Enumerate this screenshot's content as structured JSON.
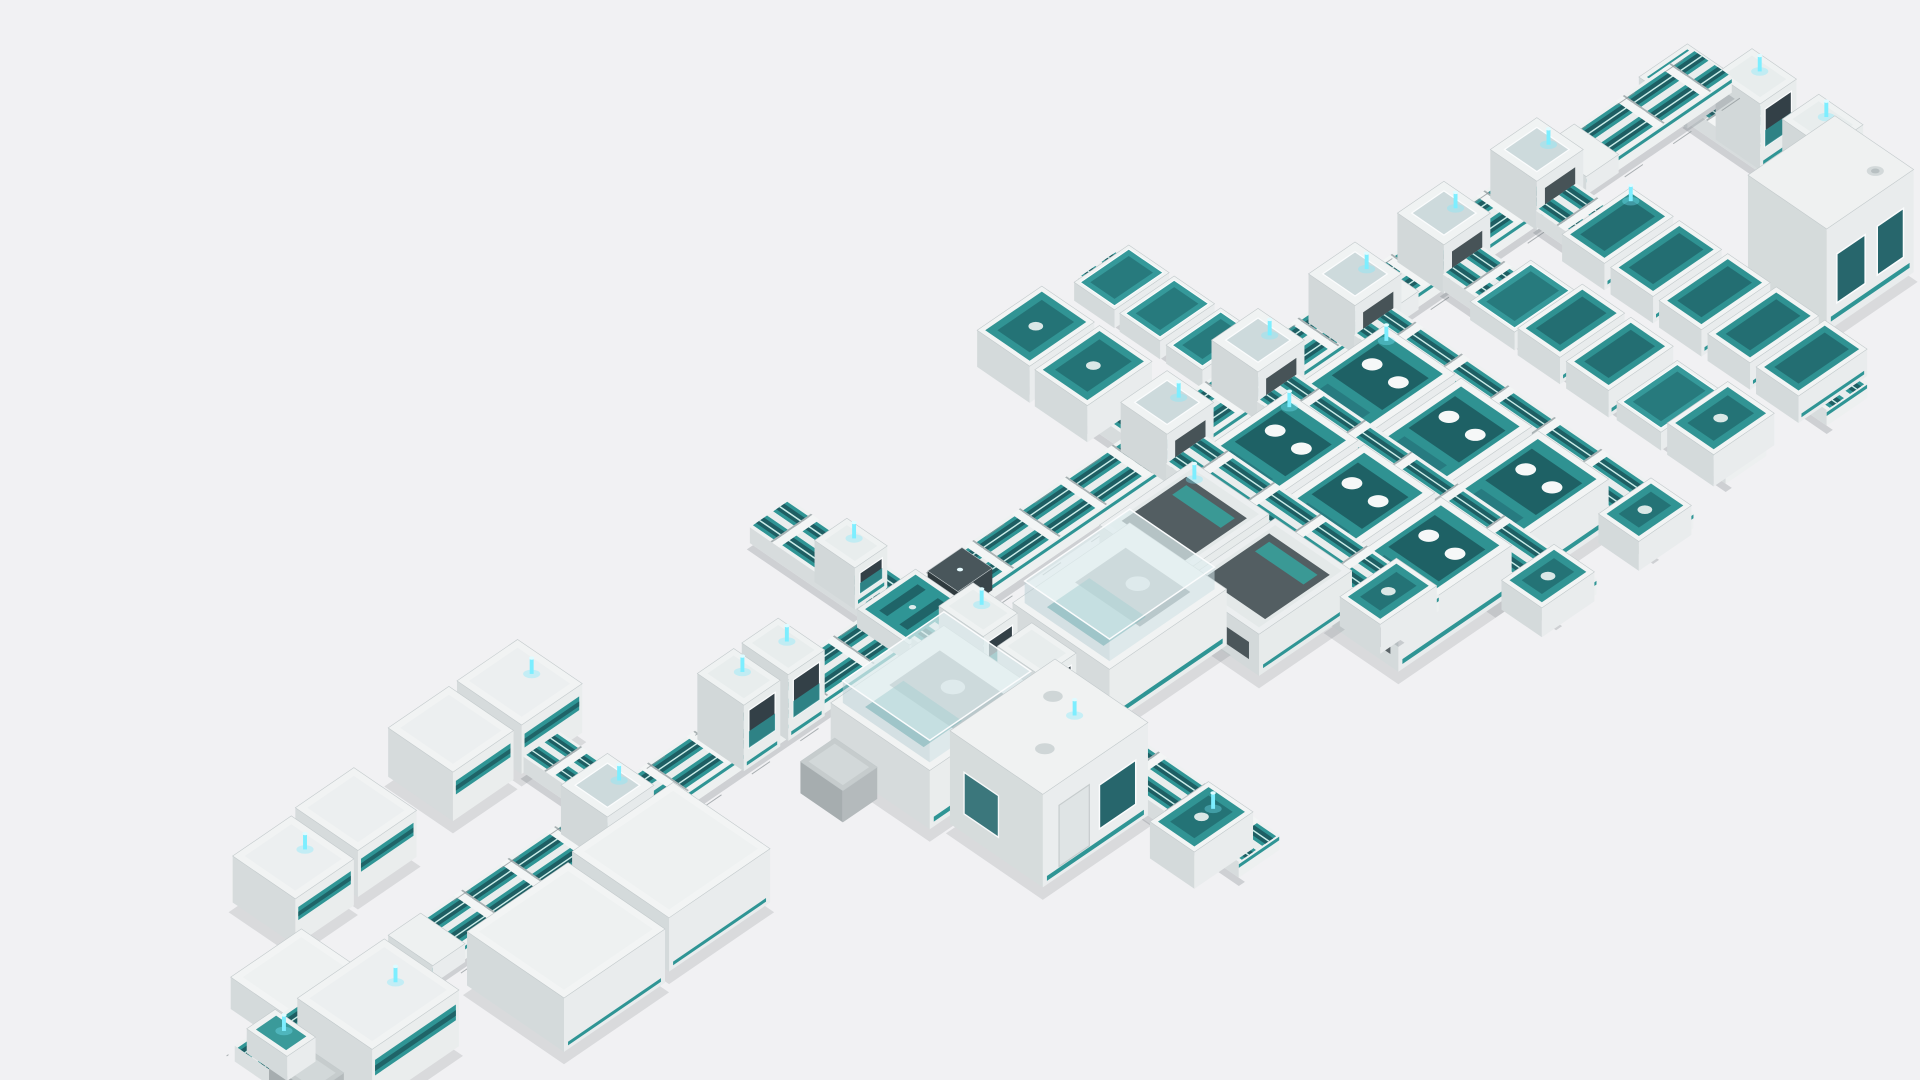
{
  "scene": {
    "name": "lab-automation-line-3d-render",
    "background": "#f1f1f3",
    "palette": {
      "bg": "#f1f1f3",
      "teal": "#2f9595",
      "tealDeck": "#2f9292",
      "tealDark": "#1e5e63",
      "tealDeep": "#1d5d62",
      "tealPale": "#c9ece8",
      "tealMid": "#26777c",
      "windowTeal": "#27666c",
      "white": "#f3f5f5",
      "topFace": "#f2f4f4",
      "seFace": "#e9eced",
      "swFace": "#d4dadb",
      "trackSide": "#edf0f0",
      "trackBase": "#eef1f1",
      "centerStrip": "#e9eded",
      "rib": "#f3f5f5",
      "ribEdge": "#a9b1b3",
      "slate": "#39454a",
      "slateLight": "#49565b",
      "slateDark": "#2f3a3e",
      "gray1": "#c6cccd",
      "gray2": "#b4babc",
      "gray3": "#a6adaf",
      "glassTop": "rgba(224,238,240,0.7)",
      "glassSE": "rgba(205,224,228,0.55)",
      "glassSW": "rgba(184,205,211,0.5)",
      "glassCube": "rgba(176,196,201,0.55)",
      "frame": "#fbfcfd",
      "beacon": "#7deeff",
      "beaconTip": "#dffbff",
      "beaconGlow": "rgba(120,235,255,0.35)",
      "shadow": "rgba(70,80,88,0.14)",
      "trackShadow": "rgba(80,92,98,0.22)",
      "guide": "#8b9396",
      "edgeStroke": "#c3cacc"
    },
    "projection": {
      "ox": 1378,
      "oy": 78,
      "ax": 0.825,
      "ay": 0.565,
      "w": 1568,
      "h": 883
    },
    "elements": [
      {
        "t": "vtrack",
        "name": "return-branch-track",
        "u": -20,
        "w": 40,
        "v0": 18,
        "v1": 164
      },
      {
        "t": "plate",
        "name": "corner-junction",
        "u": -24,
        "wu": 48,
        "v": -24,
        "wv": 48,
        "h": 15,
        "deck": true
      },
      {
        "t": "gate",
        "name": "gate-module",
        "u": -18,
        "wu": 36,
        "v": 46,
        "wv": 44,
        "h": 54,
        "beacon": true
      },
      {
        "t": "gate",
        "name": "gate-module",
        "u": -18,
        "wu": 36,
        "v": 112,
        "wv": 44,
        "h": 54,
        "beacon": true
      },
      {
        "t": "cabinet",
        "name": "analyzer-cabinet",
        "u": 16,
        "wu": 86,
        "v": 162,
        "wv": 78,
        "h": 84,
        "shadow": true
      },
      {
        "t": "vtrack",
        "name": "storage-branch-track",
        "u": 405,
        "w": 40,
        "v0": -158,
        "v1": -20
      },
      {
        "t": "tray",
        "name": "tray-module",
        "u": 398,
        "wu": 54,
        "v": -155,
        "wv": 40,
        "h": 15
      },
      {
        "t": "tray",
        "name": "tray-module",
        "u": 398,
        "wu": 54,
        "v": -110,
        "wv": 40,
        "h": 15
      },
      {
        "t": "tray",
        "name": "tray-module",
        "u": 398,
        "wu": 54,
        "v": -64,
        "wv": 36,
        "h": 15
      },
      {
        "t": "vtrack",
        "name": "io-branch-track",
        "u": 496,
        "w": 40,
        "v0": -160,
        "v1": -20
      },
      {
        "t": "deckbox",
        "name": "io-module",
        "u": 484,
        "wu": 64,
        "v": -155,
        "wv": 52,
        "h": 30
      },
      {
        "t": "deckbox",
        "name": "io-module",
        "u": 484,
        "wu": 64,
        "v": -98,
        "wv": 52,
        "h": 30
      },
      {
        "t": "vtrack",
        "name": "center-branch-track-rear",
        "u": 748,
        "w": 40,
        "v0": -140,
        "v1": -20
      },
      {
        "t": "gate",
        "name": "gate-module",
        "u": 752,
        "wu": 32,
        "v": -80,
        "wv": 40,
        "h": 34,
        "beacon": true
      },
      {
        "t": "stripbox",
        "name": "storage-module",
        "u": 1008,
        "wu": 60,
        "v": -150,
        "wv": 64,
        "h": 40,
        "beacon": true,
        "shadow": true
      },
      {
        "t": "stripbox",
        "name": "storage-module",
        "u": 1076,
        "wu": 60,
        "v": -150,
        "wv": 64,
        "h": 40,
        "shadow": true
      },
      {
        "t": "vtrack",
        "name": "storage-stub-track",
        "u": 1030,
        "w": 36,
        "v0": -86,
        "v1": -18
      },
      {
        "t": "stripbox",
        "name": "storage-module",
        "u": 1180,
        "wu": 58,
        "v": -140,
        "wv": 62,
        "h": 38,
        "shadow": true
      },
      {
        "t": "stripbox",
        "name": "storage-module",
        "u": 1246,
        "wu": 58,
        "v": -136,
        "wv": 62,
        "h": 38,
        "beacon": true,
        "shadow": true
      },
      {
        "t": "lowbox",
        "name": "side-module",
        "u": 1312,
        "wu": 70,
        "v": -60,
        "wv": 62,
        "h": 26
      },
      {
        "t": "utrack",
        "name": "main-conveyor-track",
        "u0": -24,
        "u1": 1418,
        "v": -20,
        "w": 40,
        "guides": true
      },
      {
        "t": "plate",
        "name": "track-plate",
        "u": 90,
        "wu": 32,
        "v": -22,
        "wv": 44,
        "h": 15
      },
      {
        "t": "cube",
        "name": "junction-module",
        "u": 126,
        "wu": 46,
        "v": -23,
        "wv": 46,
        "h": 40,
        "beacon": true
      },
      {
        "t": "vtrack",
        "name": "sorter-bank-track",
        "u": 130,
        "w": 40,
        "v0": 20,
        "v1": 308
      },
      {
        "t": "bin",
        "name": "sorter-bin",
        "u": 114,
        "wu": 68,
        "v": 58,
        "wv": 42,
        "h": 22,
        "beacon": true
      },
      {
        "t": "bin",
        "name": "sorter-bin",
        "u": 114,
        "wu": 68,
        "v": 106,
        "wv": 42,
        "h": 22
      },
      {
        "t": "bin",
        "name": "sorter-bin",
        "u": 114,
        "wu": 68,
        "v": 154,
        "wv": 42,
        "h": 22
      },
      {
        "t": "bin",
        "name": "sorter-bin",
        "u": 114,
        "wu": 68,
        "v": 202,
        "wv": 42,
        "h": 22
      },
      {
        "t": "bin",
        "name": "sorter-bin",
        "u": 114,
        "wu": 68,
        "v": 250,
        "wv": 42,
        "h": 22
      },
      {
        "t": "cube",
        "name": "junction-module",
        "u": 218,
        "wu": 46,
        "v": -23,
        "wv": 46,
        "h": 40,
        "beacon": true
      },
      {
        "t": "vtrack",
        "name": "buffer-bank-track",
        "u": 222,
        "w": 40,
        "v0": 20,
        "v1": 300
      },
      {
        "t": "tray",
        "name": "tray-module",
        "u": 210,
        "wu": 60,
        "v": 55,
        "wv": 44,
        "h": 15
      },
      {
        "t": "bin",
        "name": "sorter-bin",
        "u": 208,
        "wu": 64,
        "v": 104,
        "wv": 42,
        "h": 22
      },
      {
        "t": "bin",
        "name": "sorter-bin",
        "u": 208,
        "wu": 64,
        "v": 152,
        "wv": 42,
        "h": 22
      },
      {
        "t": "tray",
        "name": "tray-module",
        "u": 210,
        "wu": 60,
        "v": 200,
        "wv": 44,
        "h": 15
      },
      {
        "t": "deckbox",
        "name": "end-module",
        "u": 210,
        "wu": 60,
        "v": 250,
        "wv": 46,
        "h": 26
      },
      {
        "t": "plate",
        "name": "track-plate",
        "u": 288,
        "wu": 30,
        "v": -22,
        "wv": 44,
        "h": 15
      },
      {
        "t": "cube",
        "name": "junction-module",
        "u": 306,
        "wu": 46,
        "v": -23,
        "wv": 46,
        "h": 40,
        "beacon": true
      },
      {
        "t": "vtrack",
        "name": "analyzer-bank-track",
        "u": 310,
        "w": 40,
        "v0": 20,
        "v1": 316
      },
      {
        "t": "analyzer",
        "name": "analyzer-module",
        "u": 352,
        "wu": 112,
        "v": 52,
        "wv": 70,
        "h": 40,
        "beacon": true,
        "shadow": true
      },
      {
        "t": "analyzer",
        "name": "analyzer-module",
        "u": 352,
        "wu": 112,
        "v": 128,
        "wv": 70,
        "h": 40,
        "shadow": true
      },
      {
        "t": "analyzer",
        "name": "analyzer-module",
        "u": 352,
        "wu": 112,
        "v": 204,
        "wv": 70,
        "h": 40,
        "shadow": true
      },
      {
        "t": "deckbox",
        "name": "end-module",
        "u": 316,
        "wu": 52,
        "v": 280,
        "wv": 40,
        "h": 24
      },
      {
        "t": "cube",
        "name": "junction-module",
        "u": 402,
        "wu": 46,
        "v": -23,
        "wv": 46,
        "h": 40,
        "beacon": true
      },
      {
        "t": "vtrack",
        "name": "analyzer-bank-track",
        "u": 406,
        "w": 40,
        "v0": 20,
        "v1": 316
      },
      {
        "t": "analyzer",
        "name": "analyzer-module",
        "u": 448,
        "wu": 112,
        "v": 52,
        "wv": 70,
        "h": 40,
        "beacon": true,
        "shadow": true
      },
      {
        "t": "analyzer",
        "name": "analyzer-module",
        "u": 448,
        "wu": 112,
        "v": 128,
        "wv": 70,
        "h": 40,
        "shadow": true
      },
      {
        "t": "analyzer",
        "name": "analyzer-module",
        "u": 448,
        "wu": 112,
        "v": 204,
        "wv": 70,
        "h": 40,
        "shadow": true
      },
      {
        "t": "deckbox",
        "name": "end-module",
        "u": 412,
        "wu": 52,
        "v": 280,
        "wv": 40,
        "h": 24
      },
      {
        "t": "cube",
        "name": "junction-module",
        "u": 492,
        "wu": 46,
        "v": -23,
        "wv": 46,
        "h": 40,
        "beacon": true
      },
      {
        "t": "vtrack",
        "name": "loader-bank-track",
        "u": 496,
        "w": 40,
        "v0": 20,
        "v1": 250
      },
      {
        "t": "slotbox",
        "name": "loader-module",
        "u": 540,
        "wu": 92,
        "v": 50,
        "wv": 76,
        "h": 34,
        "beacon": true,
        "shadow": true
      },
      {
        "t": "slotbox",
        "name": "loader-module",
        "u": 540,
        "wu": 92,
        "v": 132,
        "wv": 76,
        "h": 34,
        "shadow": true
      },
      {
        "t": "deckbox",
        "name": "end-module",
        "u": 500,
        "wu": 56,
        "v": 212,
        "wv": 40,
        "h": 24
      },
      {
        "t": "reader",
        "name": "barcode-reader",
        "u": 702,
        "wu": 34,
        "v": -16,
        "wv": 30,
        "h": 18
      },
      {
        "t": "canopy",
        "name": "analyzer-canopy",
        "u": 626,
        "wu": 116,
        "v": 74,
        "wv": 96,
        "h": 46,
        "shadow": true
      },
      {
        "t": "plate",
        "name": "cross-junction",
        "u": 738,
        "wu": 58,
        "v": -26,
        "wv": 52,
        "h": 15,
        "deck": true
      },
      {
        "t": "vtrack",
        "name": "center-branch-track",
        "u": 748,
        "w": 40,
        "v0": 20,
        "v1": 344
      },
      {
        "t": "gate",
        "name": "gate-module",
        "u": 745,
        "wu": 34,
        "v": 38,
        "wv": 44,
        "h": 44,
        "beacon": true
      },
      {
        "t": "gate",
        "name": "gate-module",
        "u": 745,
        "wu": 34,
        "v": 96,
        "wv": 44,
        "h": 44
      },
      {
        "t": "canopy",
        "name": "analyzer-canopy",
        "u": 794,
        "wu": 112,
        "v": 58,
        "wv": 98,
        "h": 48,
        "shadow": true
      },
      {
        "t": "cart",
        "name": "service-cart",
        "u": 910,
        "wu": 34,
        "v": 66,
        "wv": 42,
        "h": 26
      },
      {
        "t": "cabin",
        "name": "walk-in-analyzer",
        "u": 788,
        "wu": 104,
        "v": 162,
        "wv": 92,
        "h": 76,
        "beacon": true,
        "shadow": true
      },
      {
        "t": "deckbox",
        "name": "end-module",
        "u": 760,
        "wu": 58,
        "v": 286,
        "wv": 44,
        "h": 30,
        "beacon": true
      },
      {
        "t": "gate",
        "name": "gate-module",
        "u": 876,
        "wu": 36,
        "v": -24,
        "wv": 46,
        "h": 54,
        "beacon": true
      },
      {
        "t": "gate",
        "name": "gate-module",
        "u": 920,
        "wu": 36,
        "v": -24,
        "wv": 46,
        "h": 54,
        "beacon": true
      },
      {
        "t": "cube",
        "name": "junction-module",
        "u": 1046,
        "wu": 46,
        "v": -23,
        "wv": 46,
        "h": 40,
        "beacon": true
      },
      {
        "t": "lowbox",
        "name": "analyzer-module",
        "u": 1038,
        "wu": 100,
        "v": 34,
        "wv": 96,
        "h": 44,
        "shadow": true
      },
      {
        "t": "lowbox",
        "name": "analyzer-module",
        "u": 1148,
        "wu": 100,
        "v": 40,
        "wv": 96,
        "h": 44,
        "shadow": true
      },
      {
        "t": "plate",
        "name": "track-plate",
        "u": 1232,
        "wu": 32,
        "v": -22,
        "wv": 44,
        "h": 15
      },
      {
        "t": "stripbox",
        "name": "input-module",
        "u": 1296,
        "wu": 86,
        "v": 6,
        "wv": 74,
        "h": 46,
        "beacon": true,
        "shadow": true
      },
      {
        "t": "cart",
        "name": "service-cart",
        "u": 1390,
        "wu": 30,
        "v": 16,
        "wv": 44,
        "h": 20
      },
      {
        "t": "endcap",
        "name": "track-end-cap",
        "u": 1378,
        "wu": 28,
        "v": -20,
        "wv": 40,
        "h": 20,
        "beacon": true
      }
    ]
  }
}
